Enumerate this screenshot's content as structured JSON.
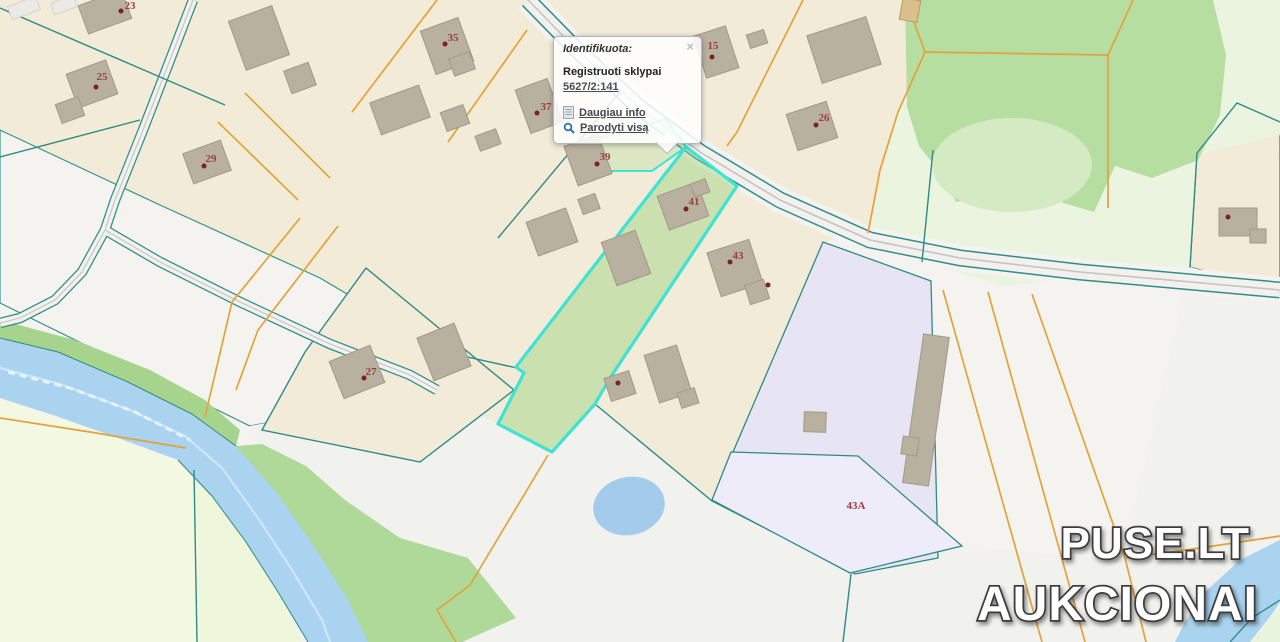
{
  "popup": {
    "title": "Identifikuota:",
    "close_label": "×",
    "result_type": "Registruoti sklypai",
    "parcel_id": "5627/2:141",
    "links": {
      "more_info": "Daugiau info",
      "show_all": "Parodyti visą"
    }
  },
  "watermark": {
    "line1": "PUSE.LT",
    "line2": "AUKCIONAI"
  },
  "map": {
    "selected_parcel_id": "5627/2:141",
    "house_labels": [
      {
        "text": "23",
        "x": 130,
        "y": 6
      },
      {
        "text": "35",
        "x": 453,
        "y": 38
      },
      {
        "text": "25",
        "x": 102,
        "y": 77
      },
      {
        "text": "37",
        "x": 546,
        "y": 107
      },
      {
        "text": "29",
        "x": 211,
        "y": 159
      },
      {
        "text": "15",
        "x": 713,
        "y": 46
      },
      {
        "text": "26",
        "x": 824,
        "y": 118
      },
      {
        "text": "39",
        "x": 605,
        "y": 157
      },
      {
        "text": "41",
        "x": 694,
        "y": 202
      },
      {
        "text": "43",
        "x": 738,
        "y": 256
      },
      {
        "text": "27",
        "x": 371,
        "y": 372
      },
      {
        "text": "43A",
        "x": 856,
        "y": 506
      }
    ],
    "markers": [
      {
        "x": 121,
        "y": 11
      },
      {
        "x": 445,
        "y": 44
      },
      {
        "x": 96,
        "y": 87
      },
      {
        "x": 537,
        "y": 113
      },
      {
        "x": 204,
        "y": 166
      },
      {
        "x": 712,
        "y": 57
      },
      {
        "x": 816,
        "y": 125
      },
      {
        "x": 597,
        "y": 164
      },
      {
        "x": 686,
        "y": 209
      },
      {
        "x": 730,
        "y": 262
      },
      {
        "x": 364,
        "y": 378
      },
      {
        "x": 768,
        "y": 285
      },
      {
        "x": 618,
        "y": 383
      },
      {
        "x": 1228,
        "y": 217
      }
    ],
    "colors": {
      "selection_outline": "#3EE3D4",
      "selection_fill": "#96D278",
      "boundary_teal": "#2E8B84",
      "boundary_orange": "#E2A33B",
      "water": "#A9D3EE",
      "parcel_beige": "#F2EBD8",
      "green_area": "#B6DEA1",
      "lavender_area": "#E7E5F4",
      "building": "#B9B19F",
      "house_label": "#9C3F3F",
      "house_dot": "#7B2320",
      "road_center": "#C6C4C0"
    }
  }
}
